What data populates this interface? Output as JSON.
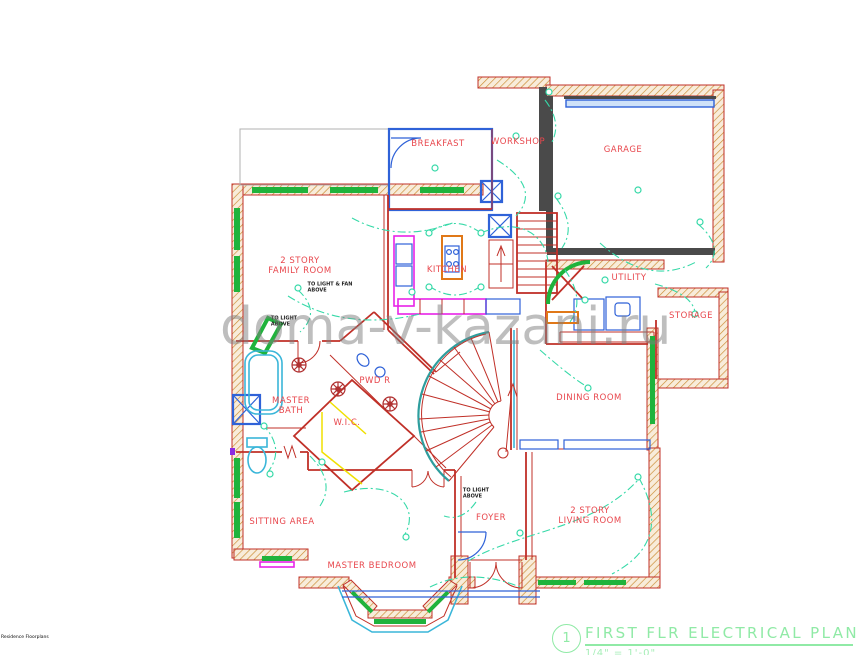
{
  "watermark": {
    "text": "doma-v-kazani.ru"
  },
  "footer_note": {
    "text": "Residence Floorplans"
  },
  "title_block": {
    "number": "1",
    "title": "FIRST FLR ELECTRICAL PLAN",
    "scale": "1/4\" = 1'-0\""
  },
  "plan": {
    "rooms": [
      {
        "label": "BREAKFAST",
        "x": 438,
        "y": 145
      },
      {
        "label": "WORKSHOP",
        "x": 518,
        "y": 143
      },
      {
        "label": "GARAGE",
        "x": 623,
        "y": 151
      },
      {
        "label": "2 STORY\nFAMILY ROOM",
        "x": 300,
        "y": 267
      },
      {
        "label": "KITCHEN",
        "x": 447,
        "y": 271
      },
      {
        "label": "UTILITY",
        "x": 629,
        "y": 279
      },
      {
        "label": "STORAGE",
        "x": 691,
        "y": 317
      },
      {
        "label": "MASTER\nBATH",
        "x": 291,
        "y": 407
      },
      {
        "label": "PWD R",
        "x": 375,
        "y": 382
      },
      {
        "label": "W.I.C.",
        "x": 347,
        "y": 424
      },
      {
        "label": "DINING ROOM",
        "x": 589,
        "y": 399
      },
      {
        "label": "SITTING AREA",
        "x": 282,
        "y": 523
      },
      {
        "label": "MASTER BEDROOM",
        "x": 372,
        "y": 567
      },
      {
        "label": "FOYER",
        "x": 491,
        "y": 519
      },
      {
        "label": "2 STORY\nLIVING ROOM",
        "x": 590,
        "y": 517
      }
    ],
    "annotations": [
      {
        "text": "TO LIGHT & FAN\nABOVE",
        "x": 330,
        "y": 288
      },
      {
        "text": "TO LIGHT\nABOVE",
        "x": 284,
        "y": 322
      },
      {
        "text": "TO LIGHT\nABOVE",
        "x": 476,
        "y": 494
      }
    ]
  },
  "colors": {
    "wall_red": "#c03028",
    "gray_wall": "#4a4a4a",
    "window_green": "#1fb33c",
    "door_blue": "#2f62d8",
    "counter_magenta": "#e822e8",
    "accent_orange": "#e07818",
    "shelf_yellow": "#f0e000",
    "fixture_cyan": "#3ab6d9",
    "teal_wall": "#2e9e9e",
    "wiring_teal": "#36d9a8",
    "label_red": "#e8474d",
    "note_black": "#222222",
    "title_green": "#90eaa6",
    "watermark_gray": "#7f7f7f",
    "hatch_tan": "#c98a2e"
  }
}
